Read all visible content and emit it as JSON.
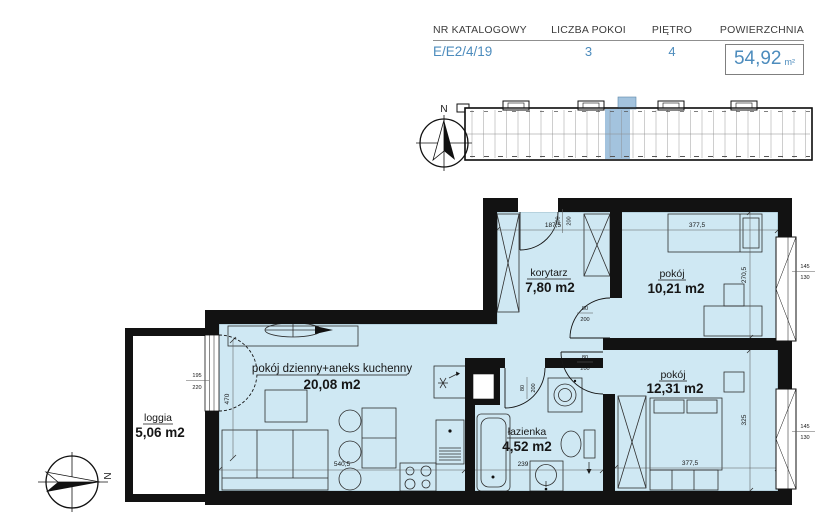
{
  "header": {
    "columns": [
      {
        "label": "NR KATALOGOWY",
        "value": "E/E2/4/19"
      },
      {
        "label": "LICZBA POKOI",
        "value": "3"
      },
      {
        "label": "PIĘTRO",
        "value": "4"
      },
      {
        "label": "POWIERZCHNIA",
        "value": "54,92",
        "unit": "m²"
      }
    ]
  },
  "rooms": {
    "korytarz": {
      "name": "korytarz",
      "area": "7,80 m2"
    },
    "pokoj_top": {
      "name": "pokój",
      "area": "10,21 m2"
    },
    "pokoj_bottom": {
      "name": "pokój",
      "area": "12,31 m2"
    },
    "living": {
      "name": "pokój dzienny+aneks kuchenny",
      "area": "20,08 m2"
    },
    "bathroom": {
      "name": "łazienka",
      "area": "4,52 m2"
    },
    "loggia": {
      "name": "loggia",
      "area": "5,06 m2"
    }
  },
  "dimensions": {
    "korytarz_width": "187,5",
    "room_top_width": "377,5",
    "room_top_height": "270,5",
    "room_bottom_width": "377,5",
    "room_bottom_height": "325",
    "living_width": "540,5",
    "living_height": "470",
    "bathroom_width": "239"
  },
  "openings": {
    "entrance_door": {
      "w": "100",
      "h": "200"
    },
    "room_top_door": {
      "w": "80",
      "h": "200"
    },
    "room_bottom_door": {
      "w": "80",
      "h": "200"
    },
    "bathroom_door": {
      "w": "80",
      "h": "200"
    },
    "balcony_door": {
      "w": "195",
      "h": "220"
    },
    "window_top": {
      "w": "145",
      "h": "130"
    },
    "window_bottom": {
      "w": "145",
      "h": "130"
    }
  },
  "compass": {
    "north": "N"
  },
  "colors": {
    "accent": "#4d8cbd",
    "room_fill": "#cfe8f3",
    "wall": "#121212",
    "unit_highlight": "#a3c3de"
  }
}
